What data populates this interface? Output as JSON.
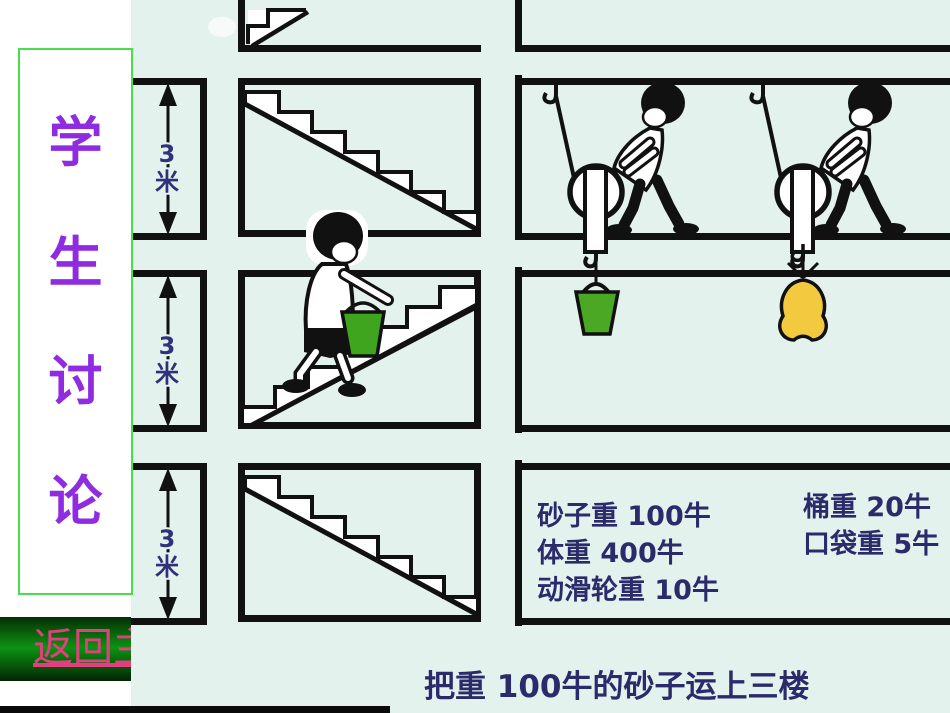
{
  "banner": {
    "title": "学生讨论",
    "chars": [
      "学",
      "生",
      "讨",
      "论"
    ]
  },
  "back_button": {
    "label": "返回主"
  },
  "dimension_labels": [
    {
      "value": "3",
      "unit": "米"
    },
    {
      "value": "3",
      "unit": "米"
    },
    {
      "value": "3",
      "unit": "米"
    }
  ],
  "info_box": {
    "left_lines": [
      "砂子重 100牛",
      "体重 400牛",
      "动滑轮重 10牛"
    ],
    "right_lines": [
      "桶重 20牛",
      "口袋重 5牛"
    ]
  },
  "caption": {
    "text": "把重 100牛的砂子运上三楼"
  },
  "figures": {
    "middle_column": "staircases with boy carrying green sand bucket",
    "right_column": "two workers lifting loads with movable pulleys; green bucket and yellow sack hang below"
  },
  "colors": {
    "slide_bg": "#e4f2ee",
    "ink": "#111111",
    "text_navy": "#2b2b6b",
    "banner_purple": "#8f2be0",
    "banner_border_green": "#4ade4a",
    "button_green": "#0d9212",
    "button_text_pink": "#e0407e",
    "bucket_green": "#3fa51e",
    "hanging_bucket_green": "#4aa825",
    "bag_yellow": "#f2c93f"
  }
}
